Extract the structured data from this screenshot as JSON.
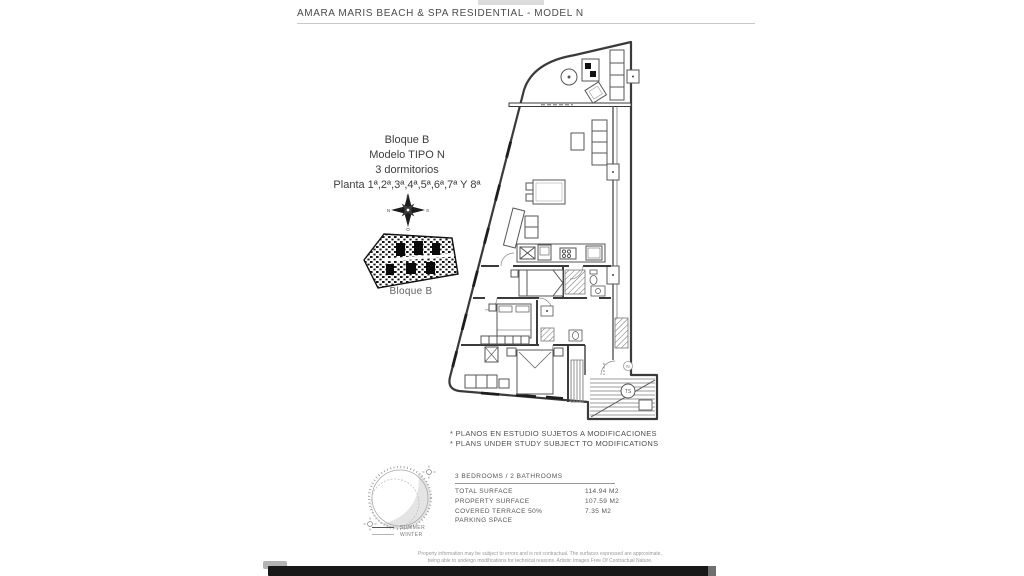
{
  "header": {
    "title": "AMARA MARIS BEACH & SPA RESIDENTIAL - MODEL N"
  },
  "info_block": {
    "lines": [
      "Bloque B",
      "Modelo TIPO N",
      "3 dormitorios",
      "Planta 1ª,2ª,3ª,4ª,5ª,6ª,7ª Y 8ª"
    ]
  },
  "compass": {
    "top": "E",
    "bottom": "O",
    "left": "N",
    "right": "S"
  },
  "site_plan": {
    "label": "Bloque B"
  },
  "floor_plan": {
    "stairs_circle_label": "TS",
    "north_marker": "N"
  },
  "notes": [
    "* PLANOS EN ESTUDIO SUJETOS A MODIFICACIONES",
    "* PLANS UNDER STUDY SUBJECT TO MODIFICATIONS"
  ],
  "sun_diagram": {
    "legend": [
      {
        "label": "SUMMER"
      },
      {
        "label": "WINTER"
      }
    ]
  },
  "surface_table": {
    "header": "3 BEDROOMS / 2 BATHROOMS",
    "rows": [
      {
        "label": "TOTAL SURFACE",
        "value": "114.94 M2"
      },
      {
        "label": "PROPERTY SURFACE",
        "value": "107.59 M2"
      },
      {
        "label": "COVERED TERRACE 50%",
        "value": "7.35 M2"
      },
      {
        "label": "PARKING SPACE",
        "value": ""
      }
    ]
  },
  "disclaimer": [
    "Property information may be subject to errors and is not contractual. The surfaces expressed are approximate,",
    "being able to undergo modifications for technical reasons. Artistic Images Free Of Contractual Nature."
  ],
  "colors": {
    "line": "#3a3a3a",
    "hatch": "#777777",
    "accent_dark": "#181818",
    "rule": "#c9c9c9"
  }
}
